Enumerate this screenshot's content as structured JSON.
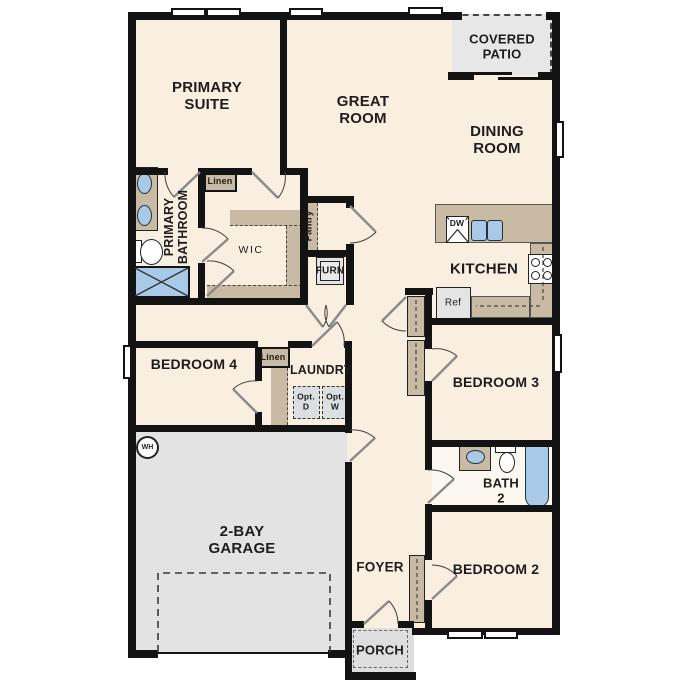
{
  "colors": {
    "wall": "#131313",
    "floor_cream": "#f8efe1",
    "floor_grey": "#e3e3e3",
    "cabinet_tan": "#c9bba3",
    "fixture_blue": "#a9c9e9",
    "label_text": "#1d1d1d"
  },
  "labels": {
    "primary_suite": "PRIMARY\nSUITE",
    "great_room": "GREAT\nROOM",
    "covered_patio": "COVERED\nPATIO",
    "dining_room": "DINING\nROOM",
    "primary_bathroom": "PRIMARY\nBATHROOM",
    "wic": "WIC",
    "linen_upper": "Linen",
    "pantry": "Pantry",
    "furn": "FURN",
    "kitchen": "KITCHEN",
    "dw": "DW",
    "ref": "Ref",
    "bedroom_4": "BEDROOM 4",
    "linen_hall": "Linen",
    "laundry": "LAUNDRY",
    "opt_d": "Opt.\nD",
    "opt_w": "Opt.\nW",
    "bedroom_3": "BEDROOM 3",
    "bath_2": "BATH\n2",
    "bedroom_2": "BEDROOM 2",
    "garage": "2-BAY\nGARAGE",
    "foyer": "FOYER",
    "porch": "PORCH",
    "wh": "WH"
  }
}
